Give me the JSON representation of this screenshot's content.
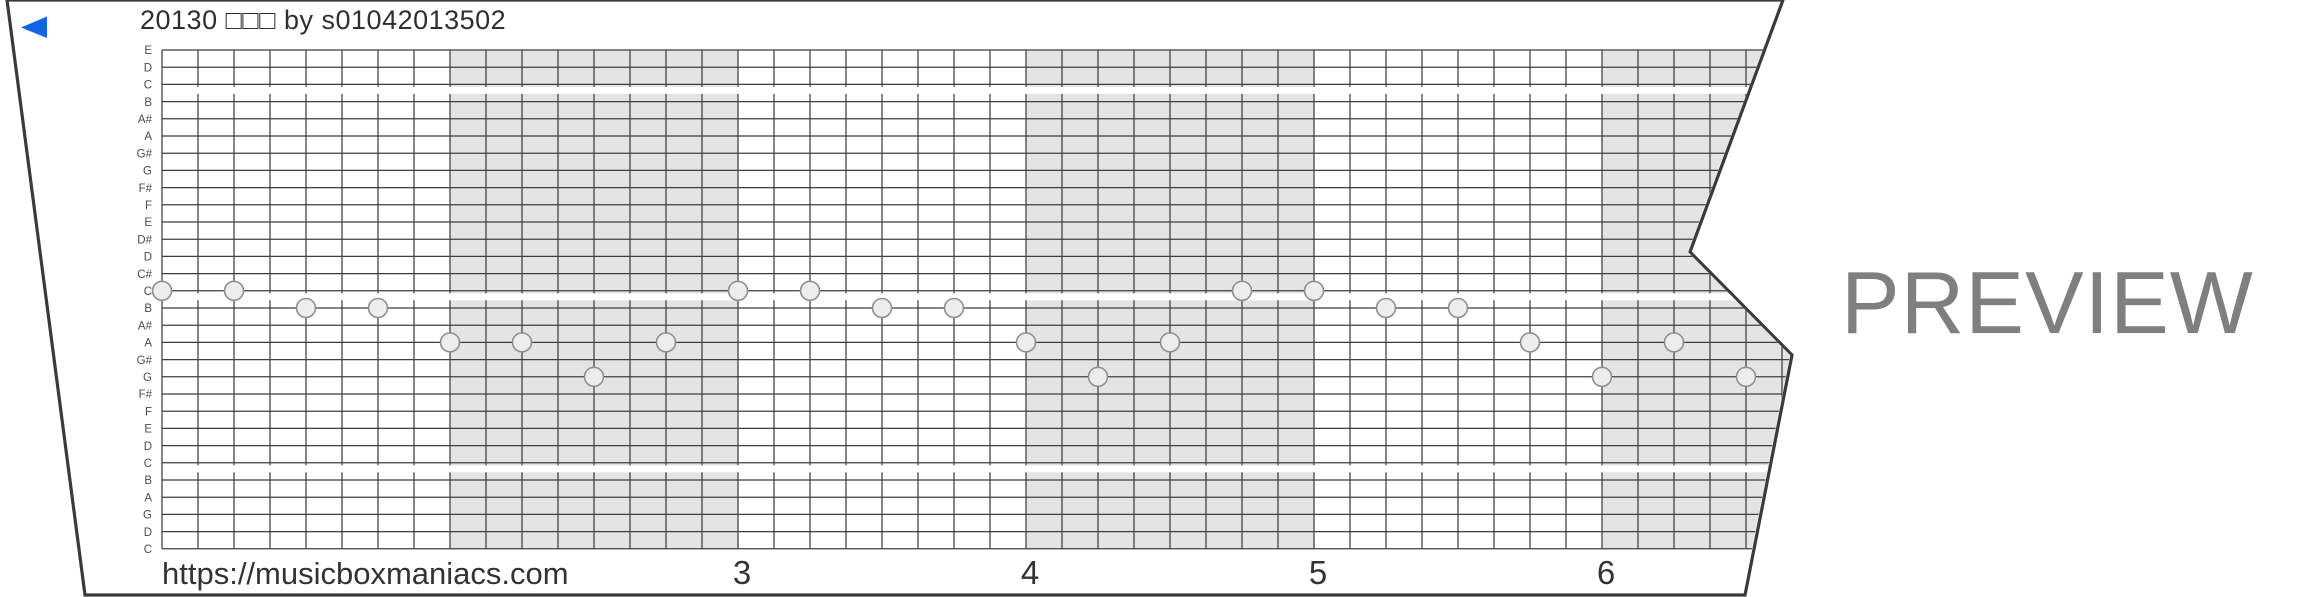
{
  "title": "20130 □□□ by s01042013502",
  "watermark": "PREVIEW",
  "play_marker_icon": "left-triangle",
  "footer": {
    "url": "https://musicboxmaniacs.com",
    "measure_numbers": [
      "3",
      "4",
      "5",
      "6"
    ]
  },
  "strip": {
    "note_labels": [
      "E",
      "D",
      "C",
      "B",
      "A#",
      "A",
      "G#",
      "G",
      "F#",
      "F",
      "E",
      "D#",
      "D",
      "C#",
      "C",
      "B",
      "A#",
      "A",
      "G#",
      "G",
      "F#",
      "F",
      "E",
      "D",
      "C",
      "B",
      "A",
      "G",
      "D",
      "C"
    ],
    "octave_breaks_after_rows": [
      2,
      14,
      24
    ],
    "beats_per_measure": 8,
    "shaded_measures": [
      2,
      4,
      6
    ],
    "notes": [
      {
        "beat": 0,
        "pitch": "C",
        "row": 14
      },
      {
        "beat": 2,
        "pitch": "C",
        "row": 14
      },
      {
        "beat": 4,
        "pitch": "B",
        "row": 15
      },
      {
        "beat": 6,
        "pitch": "B",
        "row": 15
      },
      {
        "beat": 8,
        "pitch": "A",
        "row": 17
      },
      {
        "beat": 10,
        "pitch": "A",
        "row": 17
      },
      {
        "beat": 12,
        "pitch": "G",
        "row": 19
      },
      {
        "beat": 14,
        "pitch": "A",
        "row": 17
      },
      {
        "beat": 16,
        "pitch": "C",
        "row": 14
      },
      {
        "beat": 18,
        "pitch": "C",
        "row": 14
      },
      {
        "beat": 20,
        "pitch": "B",
        "row": 15
      },
      {
        "beat": 22,
        "pitch": "B",
        "row": 15
      },
      {
        "beat": 24,
        "pitch": "A",
        "row": 17
      },
      {
        "beat": 26,
        "pitch": "G",
        "row": 19
      },
      {
        "beat": 28,
        "pitch": "A",
        "row": 17
      },
      {
        "beat": 30,
        "pitch": "C",
        "row": 14
      },
      {
        "beat": 32,
        "pitch": "C",
        "row": 14
      },
      {
        "beat": 34,
        "pitch": "B",
        "row": 15
      },
      {
        "beat": 36,
        "pitch": "B",
        "row": 15
      },
      {
        "beat": 38,
        "pitch": "A",
        "row": 17
      },
      {
        "beat": 40,
        "pitch": "G",
        "row": 19
      },
      {
        "beat": 42,
        "pitch": "A",
        "row": 17
      },
      {
        "beat": 44,
        "pitch": "G",
        "row": 19
      }
    ]
  },
  "colors": {
    "accent_blue": "#1163e4",
    "measure_shading": "#e4e4e4",
    "grid_line": "#3f3f3f",
    "strip_edge": "#3a3a3a",
    "note_fill": "#ededed",
    "note_stroke": "#8f8f8f",
    "text_dark": "#333333",
    "label_gray": "#4d4d4d",
    "watermark_gray": "#7f7f7f"
  }
}
